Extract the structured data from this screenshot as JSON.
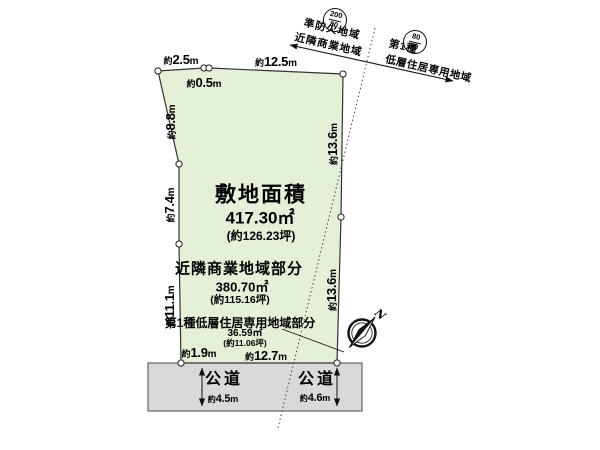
{
  "colors": {
    "plot_fill": "#e5f0d8",
    "road_fill": "#d9d9d9",
    "outline": "#2b2b2b"
  },
  "site": {
    "area_label": "敷地面積",
    "area_value": "417.30㎡",
    "area_tsubo": "(約126.23坪)",
    "commercial_label": "近隣商業地域部分",
    "commercial_value": "380.70㎡",
    "commercial_tsubo": "(約115.16坪)",
    "residential_label": "第1種低層住居専用地域部分",
    "residential_value": "36.59㎡",
    "residential_tsubo": "(約11.06坪)"
  },
  "dimensions": {
    "top_left": {
      "approx": "約",
      "value": "2.5",
      "unit": "m"
    },
    "top_offset": {
      "approx": "約",
      "value": "0.5",
      "unit": "m"
    },
    "top_main": {
      "approx": "約",
      "value": "12.5",
      "unit": "m"
    },
    "left_upper": {
      "approx": "約",
      "value": "8.8",
      "unit": "m"
    },
    "left_middle": {
      "approx": "約",
      "value": "7.4",
      "unit": "m"
    },
    "left_lower": {
      "approx": "約",
      "value": "11.1",
      "unit": "m"
    },
    "bottom_left": {
      "approx": "約",
      "value": "1.9",
      "unit": "m"
    },
    "bottom_main": {
      "approx": "約",
      "value": "12.7",
      "unit": "m"
    },
    "right_upper": {
      "approx": "約",
      "value": "13.6",
      "unit": "m"
    },
    "right_lower": {
      "approx": "約",
      "value": "13.6",
      "unit": "m"
    }
  },
  "zoning": {
    "left_ratio": {
      "numerator": "200",
      "denominator": "80"
    },
    "left_line1": "準防火地域",
    "left_line2": "近隣商業地域",
    "right_ratio": {
      "numerator": "80",
      "denominator": "50"
    },
    "right_line1": "第1種",
    "right_line2": "低層住居専用地域"
  },
  "roads": {
    "left_label": "公道",
    "left_width": {
      "approx": "約",
      "value": "4.5",
      "unit": "m"
    },
    "right_label": "公道",
    "right_width": {
      "approx": "約",
      "value": "4.6",
      "unit": "m"
    }
  },
  "compass": {
    "north_label": "N"
  }
}
